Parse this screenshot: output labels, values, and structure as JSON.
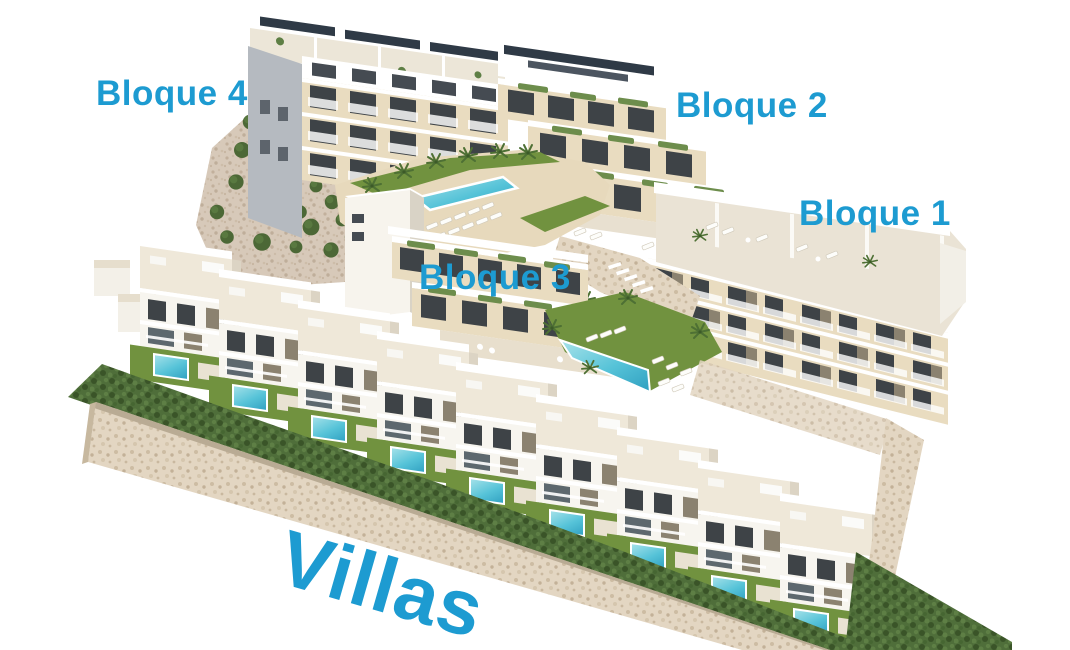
{
  "labels": {
    "bloque4": "Bloque 4",
    "bloque2": "Bloque 2",
    "bloque1": "Bloque 1",
    "bloque3": "Bloque 3",
    "villas": "Villas"
  },
  "colors": {
    "label": "#1d9bd1",
    "background": "#ffffff",
    "facade": "#e9dcc0",
    "roof_deck": "#e7d9bc",
    "pool_light": "#a9e3ea",
    "pool_dark": "#2f9fc0",
    "lawn": "#71923f",
    "hedge": "#4f6e3a",
    "gravel": "#d7c9b9",
    "stone_wall": "#e3d6c2",
    "window": "#3e4347",
    "side_wall_gray": "#b5bac0",
    "solar_panel": "#2f3a46"
  }
}
